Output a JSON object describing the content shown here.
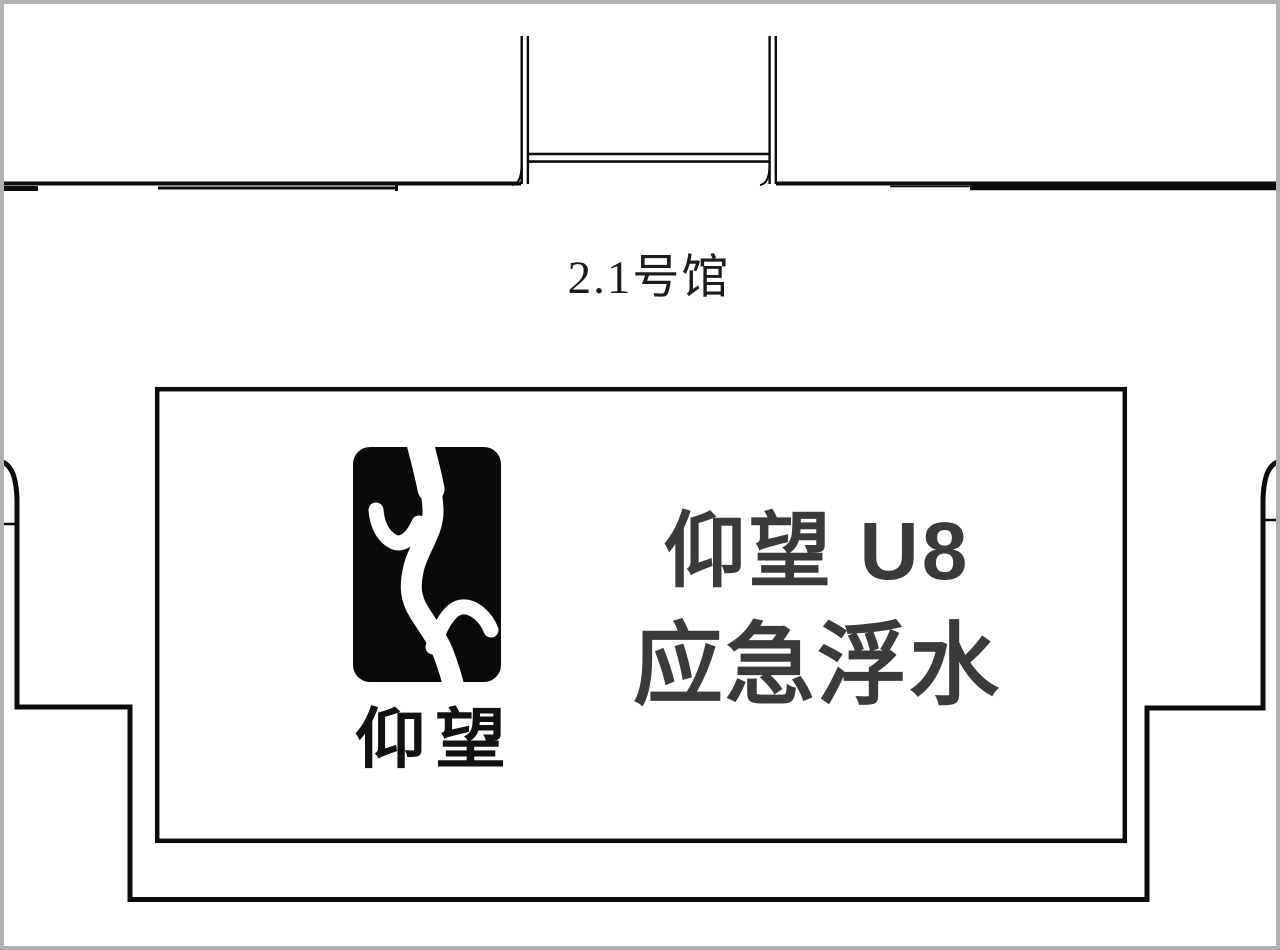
{
  "hall": {
    "label": "2.1号馆"
  },
  "booth": {
    "logo_icon": "yangwang-logo",
    "wordmark": "仰望",
    "title_line1": "仰望 U8",
    "title_line2": "应急浮水"
  },
  "colors": {
    "background": "#ffffff",
    "frame_border": "#b0b0b0",
    "wall_line": "#0b0b0b",
    "booth_outline": "#0b0b0b",
    "logo_fill": "#0a0a0a",
    "logo_mark": "#ffffff",
    "booth_text": "#3a3a3a",
    "hall_label_text": "#1c1c1c"
  }
}
